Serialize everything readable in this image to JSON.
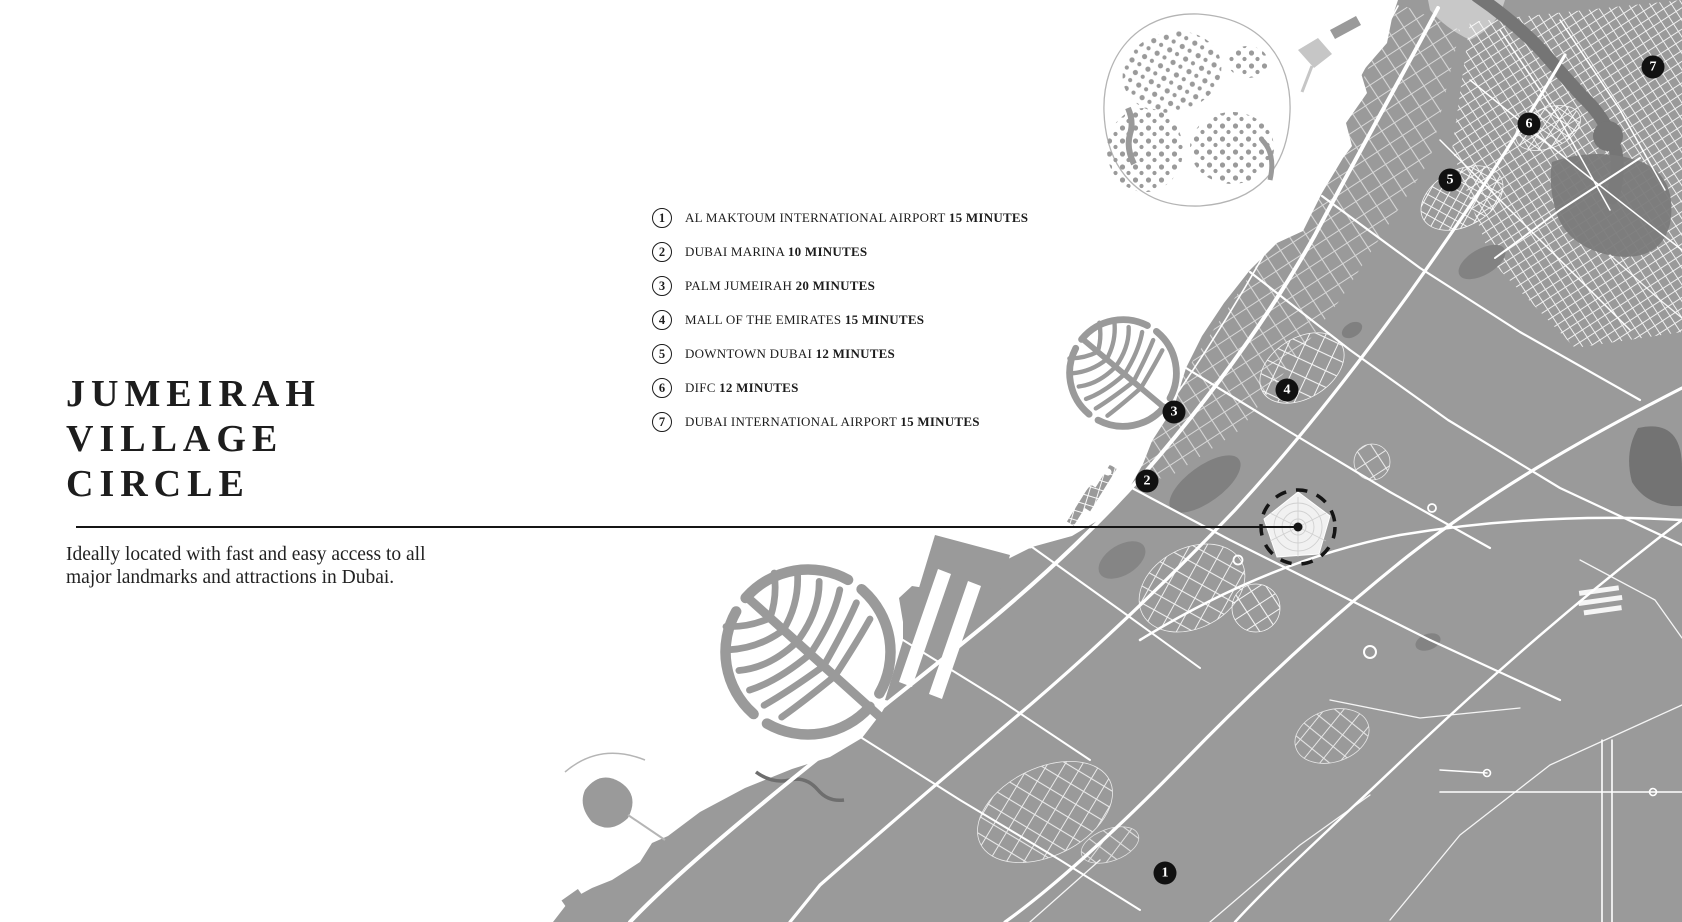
{
  "header": {
    "title_lines": [
      "JUMEIRAH",
      "VILLAGE",
      "CIRCLE"
    ],
    "description": "Ideally located with fast and easy access to all major landmarks and attractions in Dubai."
  },
  "legend": {
    "items": [
      {
        "number": "1",
        "name": "AL MAKTOUM INTERNATIONAL AIRPORT",
        "time": "15 MINUTES"
      },
      {
        "number": "2",
        "name": "DUBAI MARINA",
        "time": "10 MINUTES"
      },
      {
        "number": "3",
        "name": "PALM JUMEIRAH",
        "time": "20 MINUTES"
      },
      {
        "number": "4",
        "name": "MALL OF THE EMIRATES",
        "time": "15 MINUTES"
      },
      {
        "number": "5",
        "name": "DOWNTOWN DUBAI",
        "time": "12 MINUTES"
      },
      {
        "number": "6",
        "name": "DIFC",
        "time": "12 MINUTES"
      },
      {
        "number": "7",
        "name": "DUBAI INTERNATIONAL AIRPORT",
        "time": "15 MINUTES"
      }
    ]
  },
  "map": {
    "markers": [
      {
        "number": "1",
        "x": 1165,
        "y": 873
      },
      {
        "number": "2",
        "x": 1147,
        "y": 481
      },
      {
        "number": "3",
        "x": 1174,
        "y": 412
      },
      {
        "number": "4",
        "x": 1287,
        "y": 390
      },
      {
        "number": "5",
        "x": 1450,
        "y": 180
      },
      {
        "number": "6",
        "x": 1529,
        "y": 124
      },
      {
        "number": "7",
        "x": 1653,
        "y": 67
      }
    ],
    "highlight": {
      "label": "jumeirah-village-circle-location",
      "x": 1298,
      "y": 527
    }
  },
  "colors": {
    "land": "#9a9a9a",
    "dark_area": "#7a7a7a",
    "road": "#ffffff",
    "light_island": "#c8c8c8",
    "ink": "#151515"
  }
}
